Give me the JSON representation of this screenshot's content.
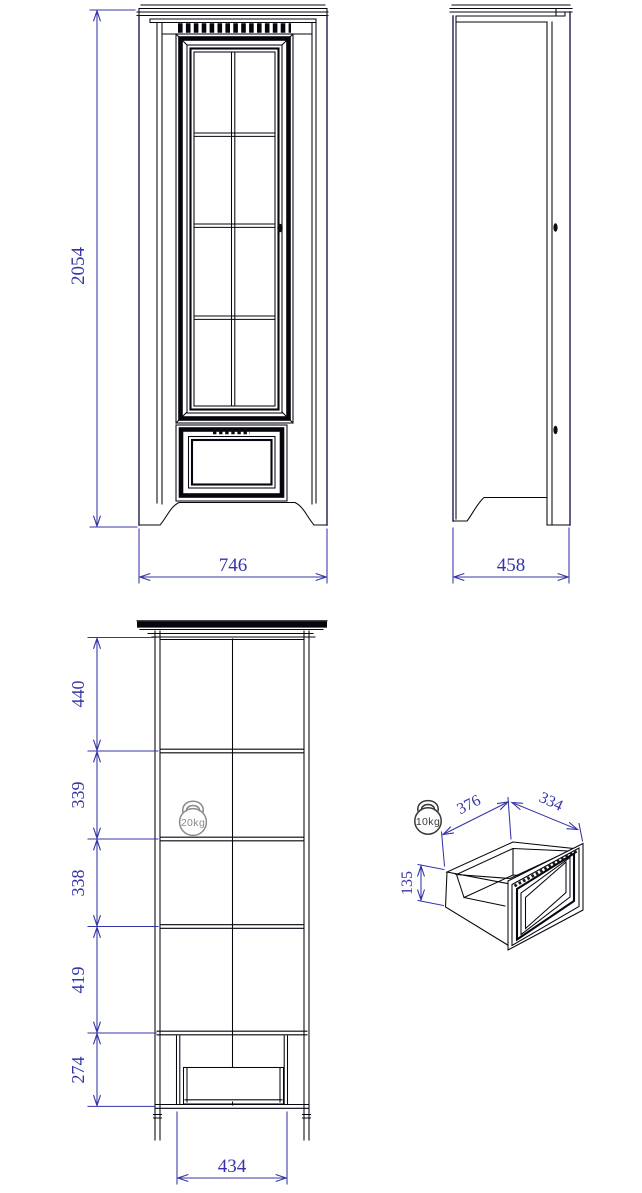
{
  "document": {
    "type": "furniture-technical-drawing",
    "views": [
      "front-elevation",
      "side-elevation",
      "internal-section",
      "drawer-isometric"
    ]
  },
  "colors": {
    "dimension": "#3434a8",
    "line": "#06060f",
    "outline": "#1d1d52",
    "load_icon_gray": "#8a8a8a",
    "load_icon_dark": "#3a3a3a",
    "paper": "#ffffff"
  },
  "front_view": {
    "height": "2054",
    "width": "746"
  },
  "side_view": {
    "depth": "458"
  },
  "section_view": {
    "segments": [
      "440",
      "339",
      "338",
      "419",
      "274"
    ],
    "drawer_opening": "434",
    "shelf_load": "20kg"
  },
  "drawer_view": {
    "depth": "376",
    "width": "334",
    "height": "135",
    "drawer_load": "10kg"
  }
}
